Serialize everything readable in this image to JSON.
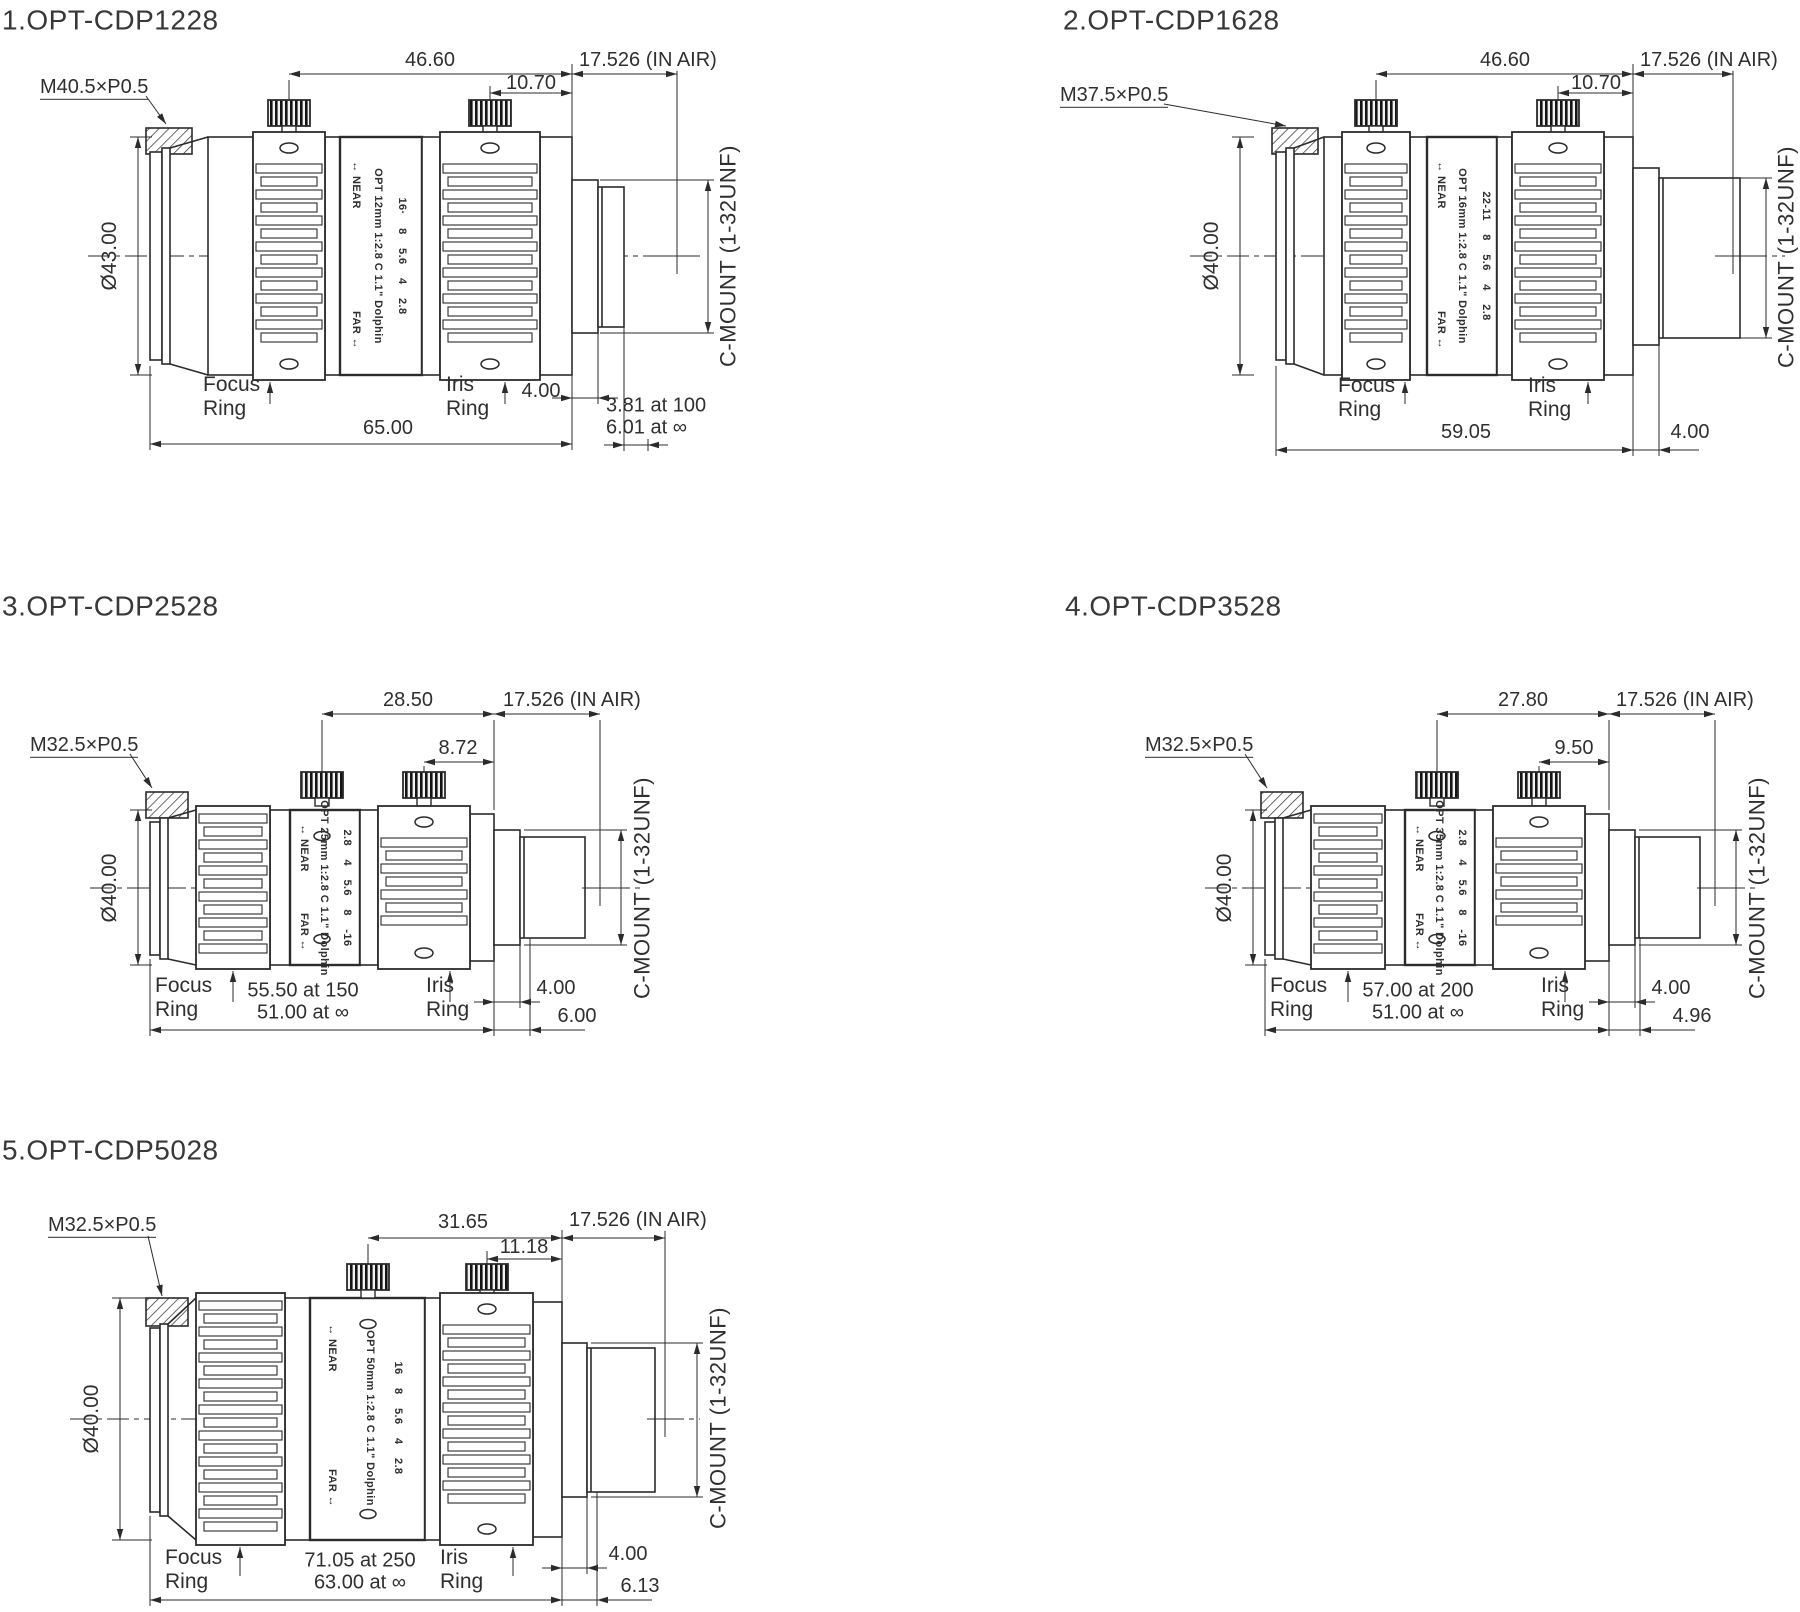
{
  "page": {
    "background": "#ffffff",
    "line_color": "#2b2b2b"
  },
  "lenses": [
    {
      "title": "1.OPT-CDP1228",
      "thread": "M40.5×P0.5",
      "diameter": "Ø43.00",
      "len_top": "46.60",
      "len_top2": "10.70",
      "in_air": "17.526 (IN AIR)",
      "barrel": {
        "near": "↔ NEAR",
        "model": "OPT 12mm 1:2.8 C 1.1\" Dolphin",
        "apertures": "16· 8 5.6 4 2.8",
        "far": "FAR ↔"
      },
      "cmount": "C-MOUNT (1-32UNF)",
      "focus_ring": "Focus\nRing",
      "iris_ring": "Iris\nRing",
      "length": "65.00",
      "dim_back": "4.00",
      "dim_back2": "3.81 at 100\n6.01 at ∞"
    },
    {
      "title": "2.OPT-CDP1628",
      "thread": "M37.5×P0.5",
      "diameter": "Ø40.00",
      "len_top": "46.60",
      "len_top2": "10.70",
      "in_air": "17.526 (IN AIR)",
      "barrel": {
        "near": "↔ NEAR",
        "model": "OPT 16mm 1:2.8 C 1.1\" Dolphin",
        "apertures": "22-11 8 5.6 4 2.8",
        "far": "FAR ↔"
      },
      "cmount": "C-MOUNT (1-32UNF)",
      "focus_ring": "Focus\nRing",
      "iris_ring": "Iris\nRing",
      "length": "59.05",
      "dim_back": "4.00"
    },
    {
      "title": "3.OPT-CDP2528",
      "thread": "M32.5×P0.5",
      "diameter": "Ø40.00",
      "len_top": "28.50",
      "len_top2": "8.72",
      "in_air": "17.526 (IN AIR)",
      "barrel": {
        "near": "↔ NEAR",
        "model": "OPT 25mm 1:2.8 C 1.1\" Dolphin",
        "apertures": "2.8 4 5.6 8 -16",
        "far": "FAR ↔"
      },
      "cmount": "C-MOUNT (1-32UNF)",
      "focus_ring": "Focus\nRing",
      "iris_ring": "Iris\nRing",
      "length": "55.50 at 150\n51.00 at ∞",
      "dim_back": "4.00",
      "dim_back2": "6.00"
    },
    {
      "title": "4.OPT-CDP3528",
      "thread": "M32.5×P0.5",
      "diameter": "Ø40.00",
      "len_top": "27.80",
      "len_top2": "9.50",
      "in_air": "17.526 (IN AIR)",
      "barrel": {
        "near": "↔ NEAR",
        "model": "OPT 35mm 1:2.8 C 1.1\" Dolphin",
        "apertures": "2.8 4 5.6 8 -16",
        "far": "FAR ↔"
      },
      "cmount": "C-MOUNT (1-32UNF)",
      "focus_ring": "Focus\nRing",
      "iris_ring": "Iris\nRing",
      "length": "57.00 at 200\n51.00 at ∞",
      "dim_back": "4.00",
      "dim_back2": "4.96"
    },
    {
      "title": "5.OPT-CDP5028",
      "thread": "M32.5×P0.5",
      "diameter": "Ø40.00",
      "len_top": "31.65",
      "len_top2": "11.18",
      "in_air": "17.526 (IN AIR)",
      "barrel": {
        "near": "↔ NEAR",
        "model": "OPT 50mm 1:2.8 C 1.1\" Dolphin",
        "apertures": "16 8 5.6 4 2.8",
        "far": "FAR ↔"
      },
      "cmount": "C-MOUNT (1-32UNF)",
      "focus_ring": "Focus\nRing",
      "iris_ring": "Iris\nRing",
      "length": "71.05 at 250\n63.00 at ∞",
      "dim_back": "4.00",
      "dim_back2": "6.13"
    }
  ]
}
